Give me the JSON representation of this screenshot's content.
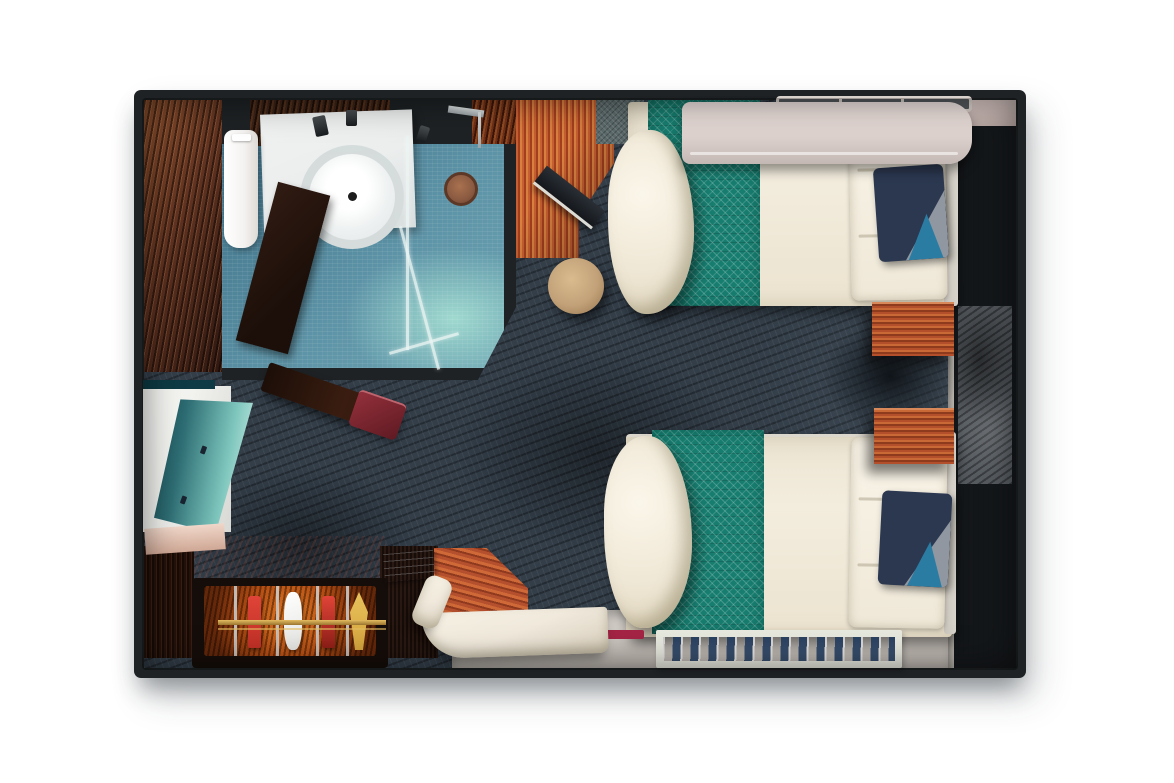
{
  "meta": {
    "view": "top-down-3d-floor-plan",
    "subject": "cruise-ship-stateroom-with-two-twin-beds-bathroom-and-balcony-door-wall"
  },
  "colors": {
    "background": "#ffffff",
    "wall": "#1e2224",
    "carpet_base": "#333e49",
    "bathroom_floor": "#5d93a6",
    "bathroom_floor_deep": "#3f7289",
    "bathroom_glow": "#9fd9cf",
    "wood_entry": "#5f3220",
    "desk_wood_light": "#d8813f",
    "laptop_dark": "#14181d",
    "stool": "#c2a178",
    "bed_linen": "#f3edde",
    "bed_frame": "#d8d4cc",
    "runner_teal": "#177d6f",
    "pillow_navy": "#2b3850",
    "pillow_grey": "#9097a1",
    "pillow_teal": "#2b7ca3",
    "pullman": "#ded2ce",
    "pullman_dark": "#c4b8b5",
    "rail_light": "#d9d1cb",
    "window_cream": "#e6dfd7",
    "window_glass": "#565b60",
    "window_frame": "#14171a",
    "sill": "#b9b4ac",
    "floor_light": "#cbc5bf",
    "rug_frame": "#e7e9df",
    "rug_water": "#2d5d96",
    "rug_water_dark": "#16345c",
    "seat_white": "#f0e9dc",
    "cabinet_dark": "#150d09",
    "glow_orange": "#e07a24",
    "glow_deep": "#63270a",
    "bottle_red": "#c03026",
    "bottle_white": "#e3e3e0",
    "bottle_gold": "#d5a43d",
    "brass": "#9a742e",
    "chrome": "#ccd2d4",
    "bench_wood": "#3a1d10",
    "bench_pad": "#5f1a22",
    "tv_screen_dark": "#0d3a44",
    "tv_screen_light": "#d6f2ea",
    "tv_back": "#f2f2ef",
    "tv_base": "#cfa795",
    "mat_brown": "#8a5a41",
    "toilet_white": "#f4f2f0",
    "sink_white": "#eceeee",
    "mat_entry": "#5c6a6b",
    "accent_crimson": "#a42445",
    "strip_white": "#eceae2"
  },
  "scene": {
    "rooms": [
      {
        "name": "entry-corridor"
      },
      {
        "name": "bathroom"
      },
      {
        "name": "sleeping-area"
      },
      {
        "name": "sitting-area"
      },
      {
        "name": "balcony-door-wall"
      }
    ],
    "furniture": [
      "toilet",
      "sink-vanity",
      "sink-bowl",
      "bathroom-door",
      "shower-glass-partition",
      "shower-mat",
      "shower-fixture",
      "entry-door-mat",
      "writing-desk",
      "laptop",
      "round-stool",
      "twin-bed-upper",
      "twin-bed-lower",
      "teal-bed-runner-upper",
      "teal-bed-runner-lower",
      "accent-pillow-upper",
      "accent-pillow-lower",
      "pullman-berth",
      "grab-rail",
      "nightstand-upper",
      "nightstand-lower",
      "balcony-sliding-door",
      "curtain-panel-upper",
      "curtain-panel-lower",
      "area-rug",
      "ottoman-table",
      "corner-seat",
      "side-cabinet",
      "documents",
      "tv-screen",
      "media-console",
      "upholstered-bench",
      "minibar-cabinet",
      "bottle-red-1",
      "bottle-sculpture",
      "bottle-red-2",
      "bottle-gold",
      "brass-rail",
      "floor-strip-white",
      "floor-strip-crimson"
    ]
  }
}
